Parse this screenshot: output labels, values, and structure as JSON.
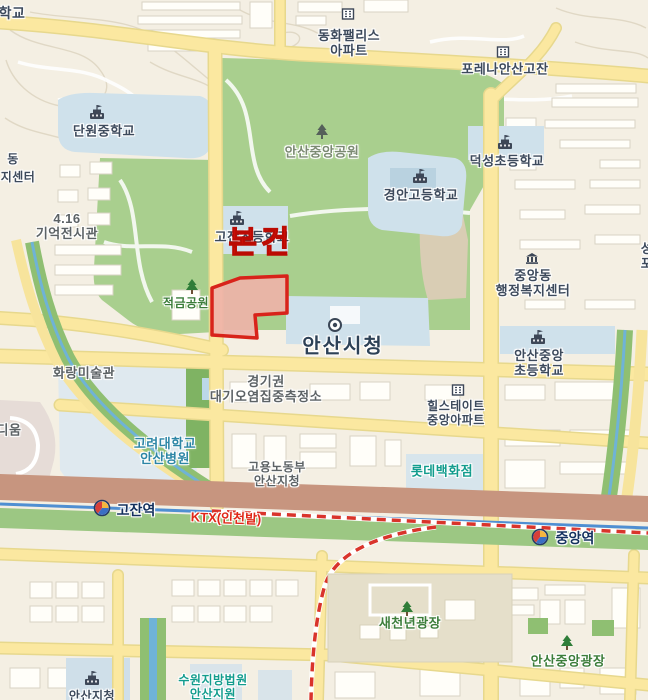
{
  "map": {
    "palette": {
      "background": "#f4efe3",
      "park_green": "#a9cf8e",
      "road_yellow": "#fbe8a0",
      "railway_brown": "#c7957f",
      "rail_line_blue": "#4f8fd2",
      "ktx_dash_red": "#d9342b",
      "campus_blue": "#cfe1eb",
      "subject_outline_red": "#d8231a",
      "subject_fill_pink": "#eeb1a9",
      "subject_text_red": "#e8150d"
    },
    "labels": {
      "school_partial_tl": "학교",
      "donghwa_palace_apt": "동화팰리스\n아파트",
      "forena_ansan_gojan": "포레나안산고잔",
      "danwon_middle_school": "단원중학교",
      "dong_partial": "동",
      "jicenter_partial": "지센터",
      "memorial_416": "4.16\n기억전시관",
      "ansan_central_park": "안산중앙공원",
      "gyeongan_high_school": "경안고등학교",
      "deokseong_elementary": "덕성초등학교",
      "gojan_elementary": "고잔초등학교",
      "subject_marker": "본건",
      "jeokgeum_park": "적금공원",
      "seongpo_partial": "성포",
      "jungangdong_community_center": "중앙동\n행정복지센터",
      "ansan_city_hall": "안산시청",
      "ansan_jungang_elementary": "안산중앙\n초등학교",
      "hwarang_art_museum": "화랑미술관",
      "dium_partial": "디움",
      "gyeonggi_air_monitoring": "경기권\n대기오염집중측정소",
      "hillstate_jungang_apt": "힐스테이트\n중앙아파트",
      "korea_univ_ansan_hospital": "고려대학교\n안산병원",
      "moel_ansan_office": "고용노동부\n안산지청",
      "lotte_department_store": "롯데백화점",
      "gojan_station": "고잔역",
      "ktx_incheon_line": "KTX(인천발)",
      "jungang_station": "중앙역",
      "saecheonnyeon_plaza": "새천년광장",
      "ansan_jungang_plaza": "안산중앙광장",
      "suwon_court_ansan_branch": "수원지방법원\n안산지원",
      "ansan_jicheong_partial": "안산지청"
    }
  }
}
